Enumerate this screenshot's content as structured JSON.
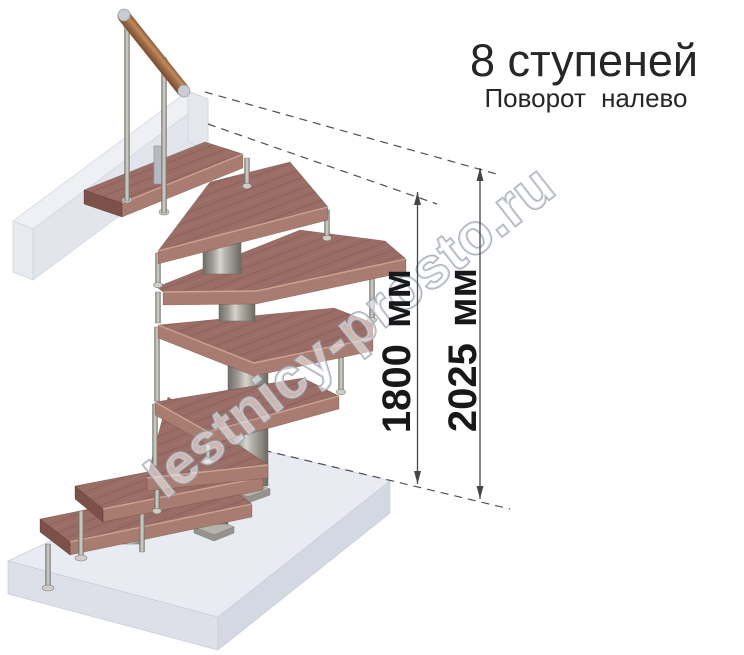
{
  "header": {
    "title": "8 ступеней",
    "subtitle": "Поворот налево"
  },
  "dimensions": {
    "to_landing": {
      "label": "1800 мм"
    },
    "total_height": {
      "label": "2025 мм"
    }
  },
  "watermark": {
    "text": "lestnicy-prosto.ru"
  },
  "stairs": {
    "steps_count": 8,
    "turn_direction": "налево",
    "parts": [
      "handrail",
      "balusters",
      "wood-treads",
      "steel-columns",
      "support-rods",
      "floor-slab",
      "upper-floor-beam"
    ]
  },
  "colors": {
    "tread_wood": "#9a6e66",
    "tread_edge": "#a87c70",
    "tread_side": "#7b514a",
    "handrail_wood": "#a5714a",
    "metal": "#b3b1a9",
    "floor_slab": "#e9ebf2",
    "beam": "#eef0f6",
    "title_text": "#262626",
    "dimension_text": "#17181a",
    "dimension_line": "#44464a",
    "watermark_outline": "#9aa1ab",
    "background": "#ffffff"
  }
}
